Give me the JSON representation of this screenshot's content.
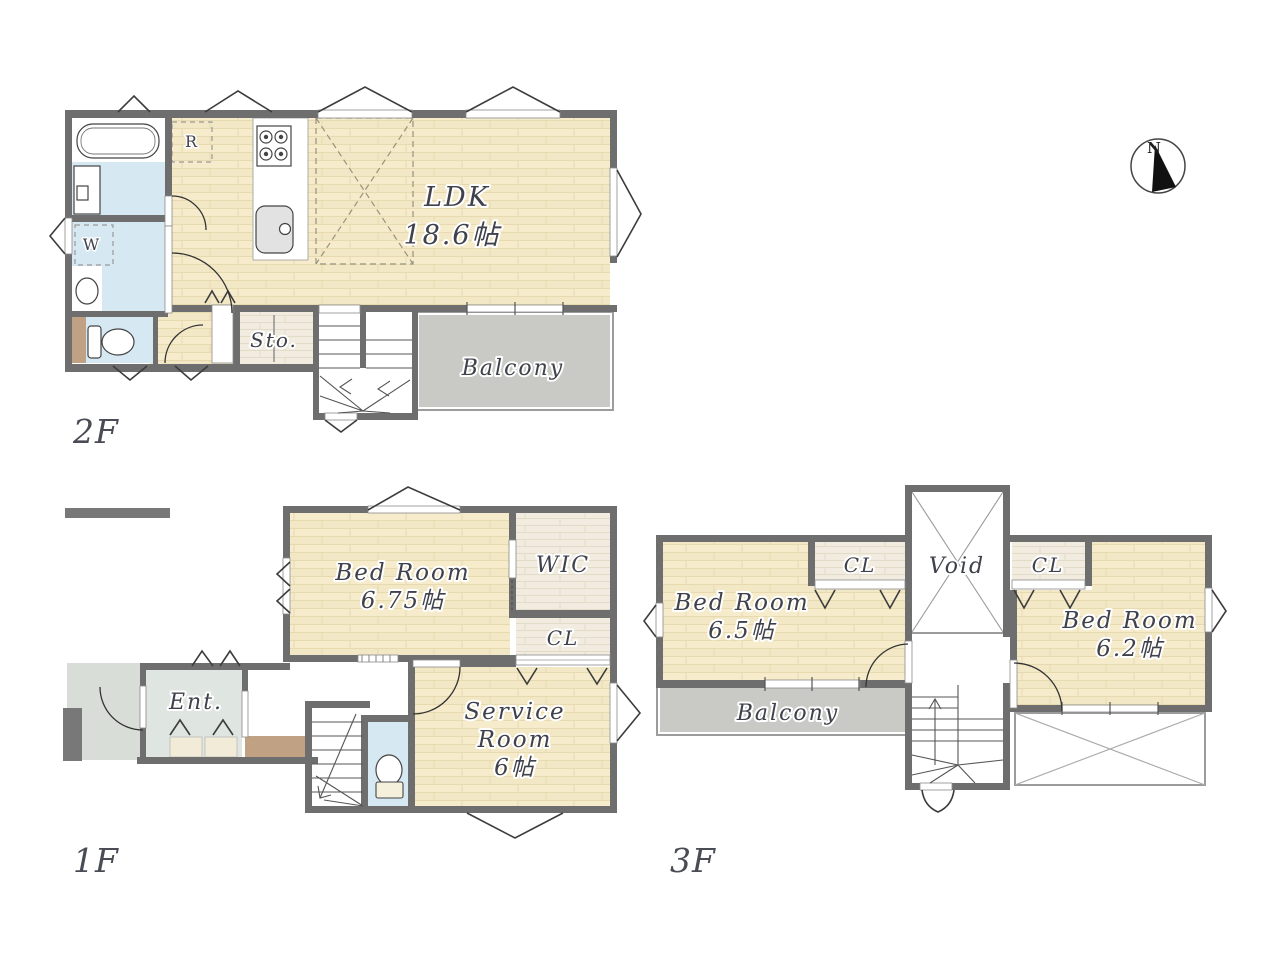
{
  "compass": {
    "north_label": "N"
  },
  "floor_2f": {
    "label": "2F",
    "ldk_name": "LDK",
    "ldk_size": "18.6帖",
    "storage": "Sto.",
    "balcony": "Balcony",
    "refrigerator": "R",
    "washer": "W"
  },
  "floor_1f": {
    "label": "1F",
    "bedroom_name": "Bed Room",
    "bedroom_size": "6.75帖",
    "wic": "WIC",
    "closet": "CL",
    "entrance": "Ent.",
    "service_line1": "Service",
    "service_line2": "Room",
    "service_line3": "6帖"
  },
  "floor_3f": {
    "label": "3F",
    "bedroom_left_name": "Bed Room",
    "bedroom_left_size": "6.5帖",
    "closet_left": "CL",
    "void": "Void",
    "closet_right": "CL",
    "bedroom_right_name": "Bed Room",
    "bedroom_right_size": "6.2帖",
    "balcony": "Balcony"
  },
  "colors": {
    "wall": "#6e6e6e",
    "wood_floor": "#f3e8c5",
    "closet_wood": "#f1ecdf",
    "balcony_gray": "#c9cac5",
    "water_room_blue": "#d6e8f2",
    "entrance_floor": "#dfe5e0",
    "approach_gray": "#d8ddd7",
    "step_brown": "#c0a183",
    "label_text": "#3f414b"
  }
}
